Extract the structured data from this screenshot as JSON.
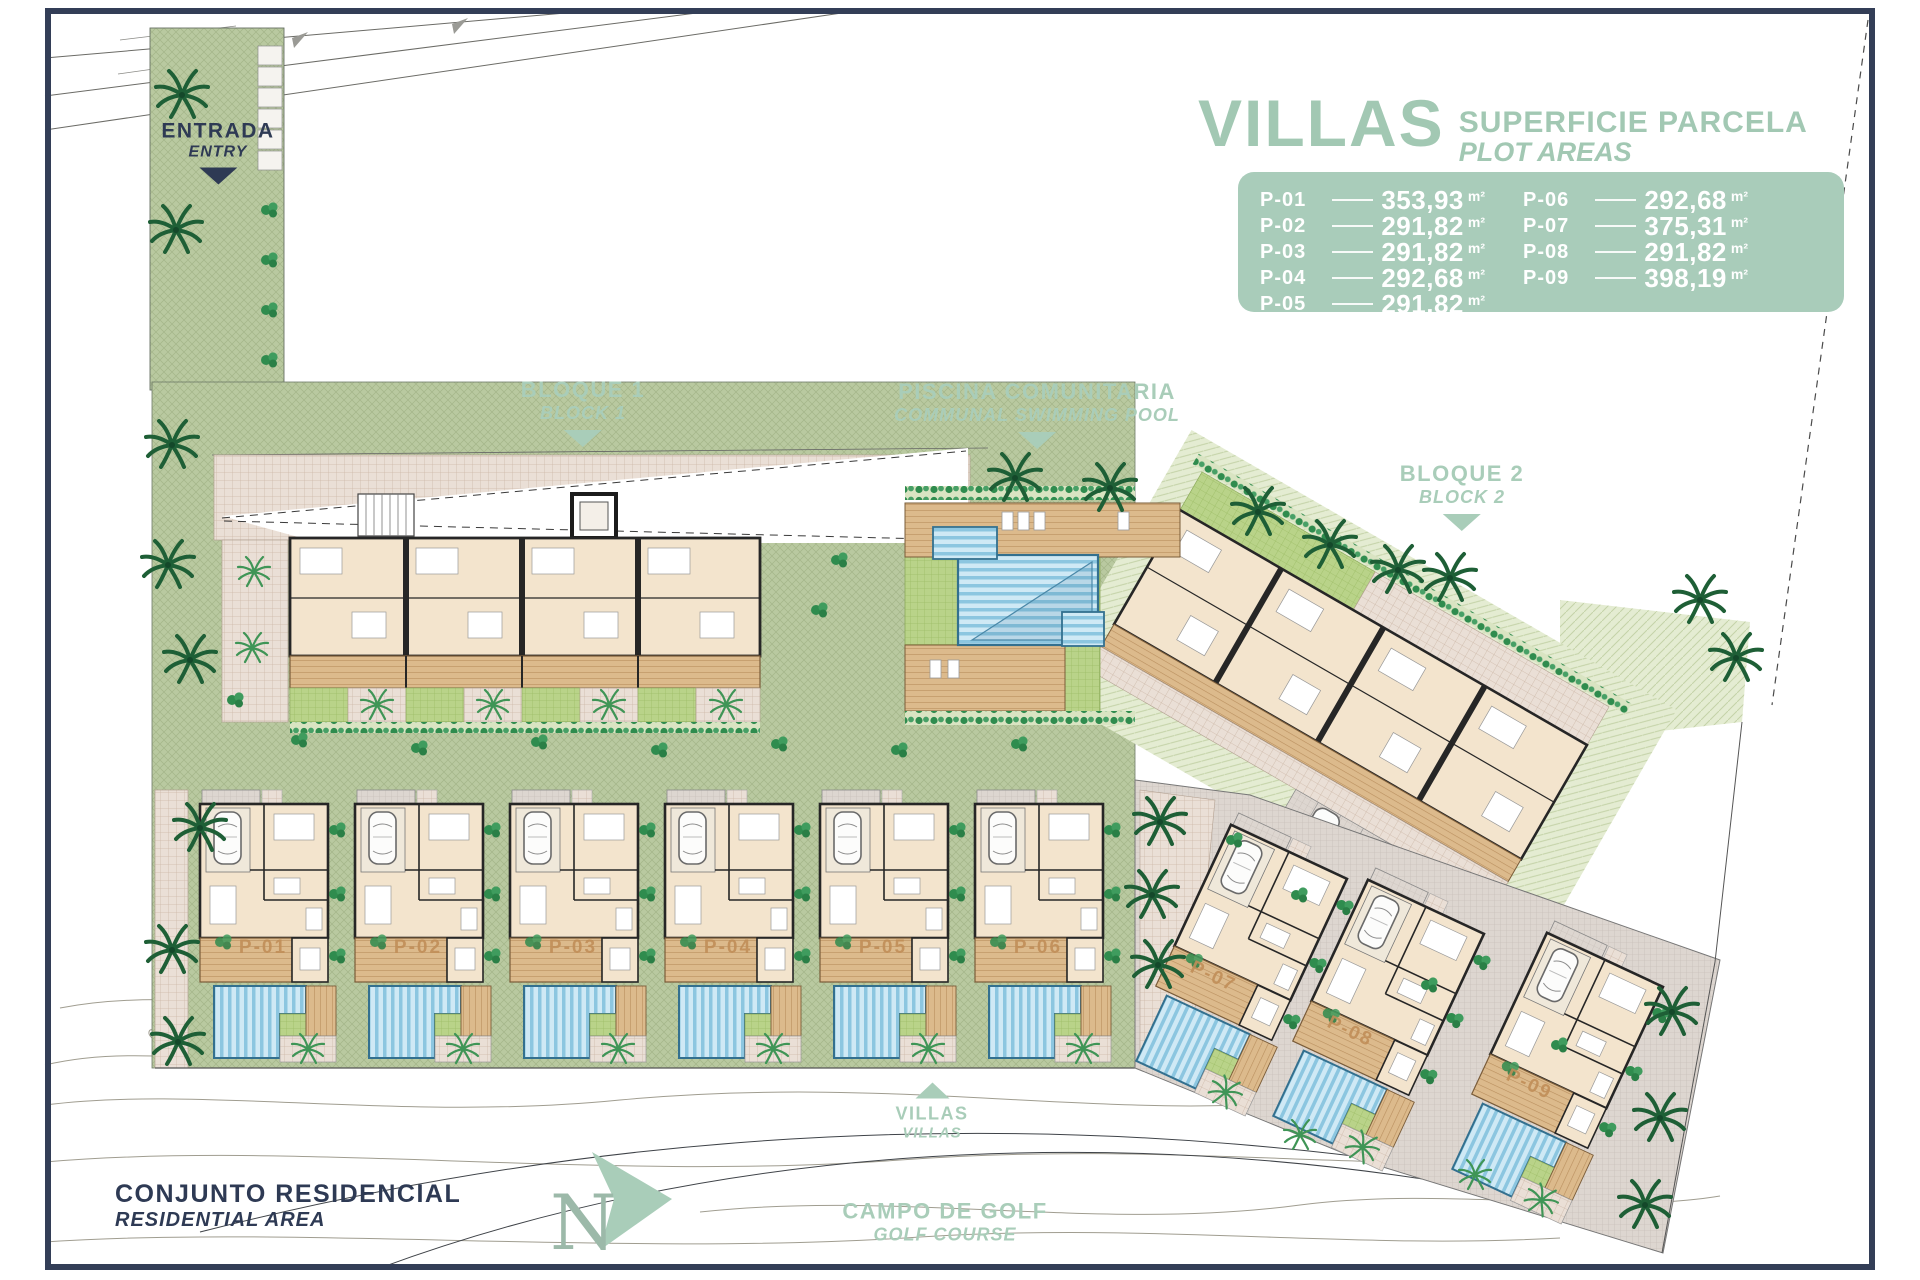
{
  "legend": {
    "title": "VILLAS",
    "subtitle_es": "SUPERFICIE PARCELA",
    "subtitle_en": "PLOT AREAS",
    "unit": "m²",
    "left": [
      {
        "plot": "P-01",
        "area": "353,93"
      },
      {
        "plot": "P-02",
        "area": "291,82"
      },
      {
        "plot": "P-03",
        "area": "291,82"
      },
      {
        "plot": "P-04",
        "area": "292,68"
      },
      {
        "plot": "P-05",
        "area": "291,82"
      }
    ],
    "right": [
      {
        "plot": "P-06",
        "area": "292,68"
      },
      {
        "plot": "P-07",
        "area": "375,31"
      },
      {
        "plot": "P-08",
        "area": "291,82"
      },
      {
        "plot": "P-09",
        "area": "398,19"
      }
    ]
  },
  "labels": {
    "entry": {
      "es": "ENTRADA",
      "en": "ENTRY"
    },
    "block1": {
      "es": "BLOQUE 1",
      "en": "BLOCK 1"
    },
    "pool": {
      "es": "PISCINA COMUNITARIA",
      "en": "COMMUNAL SWIMMING POOL"
    },
    "block2": {
      "es": "BLOQUE 2",
      "en": "BLOCK 2"
    },
    "villas": {
      "es": "VILLAS",
      "en": "VILLAS"
    },
    "residential": {
      "es": "CONJUNTO RESIDENCIAL",
      "en": "RESIDENTIAL AREA"
    },
    "golf": {
      "es": "CAMPO DE GOLF",
      "en": "GOLF COURSE"
    },
    "north": "N"
  },
  "plots": [
    {
      "id": "P-01",
      "x": 263,
      "y": 948,
      "rot": 0
    },
    {
      "id": "P-02",
      "x": 418,
      "y": 948,
      "rot": 0
    },
    {
      "id": "P-03",
      "x": 573,
      "y": 948,
      "rot": 0
    },
    {
      "id": "P-04",
      "x": 728,
      "y": 948,
      "rot": 0
    },
    {
      "id": "P-05",
      "x": 883,
      "y": 948,
      "rot": 0
    },
    {
      "id": "P-06",
      "x": 1038,
      "y": 948,
      "rot": 0
    },
    {
      "id": "P-07",
      "x": 1213,
      "y": 977,
      "rot": 25
    },
    {
      "id": "P-08",
      "x": 1350,
      "y": 1032,
      "rot": 25
    },
    {
      "id": "P-09",
      "x": 1529,
      "y": 1085,
      "rot": 25
    }
  ],
  "colors": {
    "accent_green": "#a9cdb9",
    "panel_green": "#a9ccba",
    "navy": "#2e3a54",
    "pool_blue": "#8cc6e0",
    "plot_label": "#c18e58",
    "site_green": "#b9c9a0"
  }
}
